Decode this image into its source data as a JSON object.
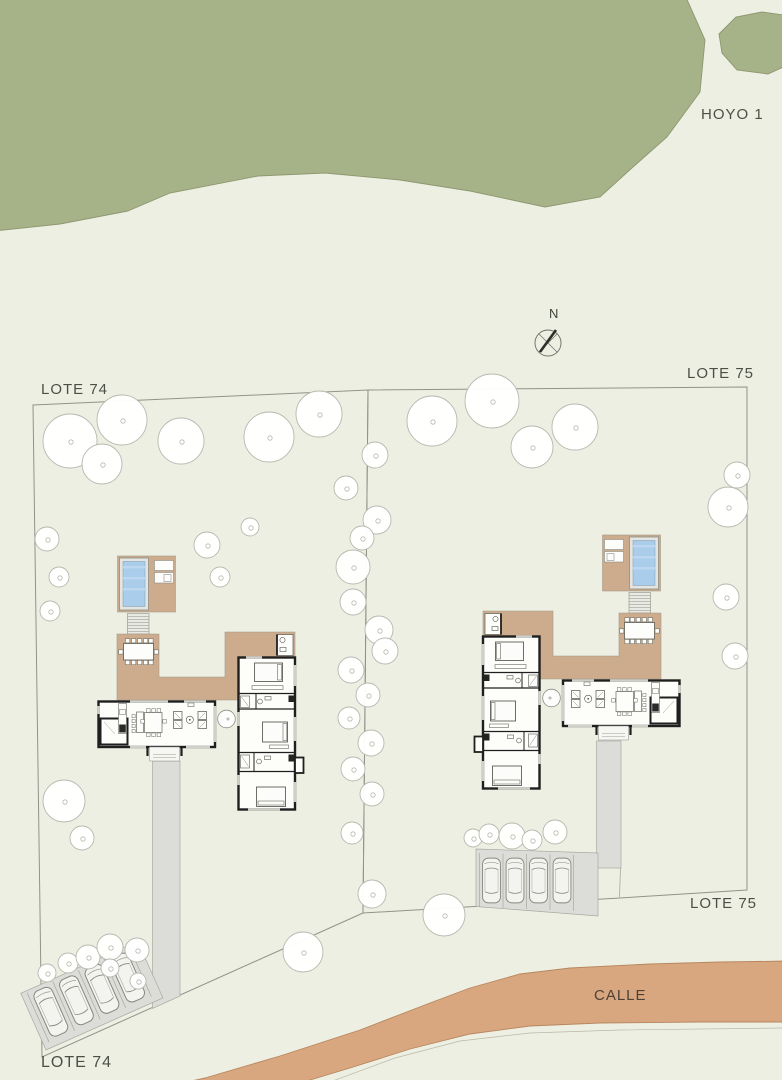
{
  "labels": {
    "golf_hole": "HOYO 1",
    "lot74_top": "LOTE 74",
    "lot74_bottom": "LOTE 74",
    "lot75_top": "LOTE 75",
    "lot75_bottom": "LOTE 75",
    "street": "CALLE",
    "north": "N"
  },
  "colors": {
    "background": "#edefe2",
    "golf_green": "#a6b288",
    "street": "#d8a67f",
    "terrace_tan": "#cdab8d",
    "pool_water": "#a9cdea",
    "paving_gray": "#dcddd8",
    "wall_black": "#1f1f1f",
    "boundary_line": "#8f948a",
    "tree_outline": "#b5b9af",
    "label_text": "#4b5046"
  },
  "site": {
    "lots": [
      {
        "id": "lot-74",
        "label": "LOTE 74"
      },
      {
        "id": "lot-75",
        "label": "LOTE 75"
      }
    ],
    "houses": 2,
    "trees": [
      [
        70,
        441,
        27
      ],
      [
        122,
        420,
        25
      ],
      [
        102,
        464,
        20
      ],
      [
        181,
        441,
        23
      ],
      [
        269,
        437,
        25
      ],
      [
        319,
        414,
        23
      ],
      [
        432,
        421,
        25
      ],
      [
        492,
        401,
        27
      ],
      [
        532,
        447,
        21
      ],
      [
        575,
        427,
        23
      ],
      [
        47,
        539,
        12
      ],
      [
        59,
        577,
        10
      ],
      [
        50,
        611,
        10
      ],
      [
        207,
        545,
        13
      ],
      [
        220,
        577,
        10
      ],
      [
        250,
        527,
        9
      ],
      [
        375,
        455,
        13
      ],
      [
        346,
        488,
        12
      ],
      [
        377,
        520,
        14
      ],
      [
        362,
        538,
        12
      ],
      [
        353,
        567,
        17
      ],
      [
        353,
        602,
        13
      ],
      [
        379,
        630,
        14
      ],
      [
        385,
        651,
        13
      ],
      [
        351,
        670,
        13
      ],
      [
        368,
        695,
        12
      ],
      [
        349,
        718,
        11
      ],
      [
        371,
        743,
        13
      ],
      [
        353,
        769,
        12
      ],
      [
        372,
        794,
        12
      ],
      [
        64,
        801,
        21
      ],
      [
        82,
        838,
        12
      ],
      [
        352,
        833,
        11
      ],
      [
        47,
        973,
        9
      ],
      [
        68,
        963,
        10
      ],
      [
        88,
        957,
        12
      ],
      [
        110,
        947,
        13
      ],
      [
        137,
        950,
        12
      ],
      [
        110,
        968,
        9
      ],
      [
        138,
        981,
        8
      ],
      [
        303,
        952,
        20
      ],
      [
        444,
        915,
        21
      ],
      [
        372,
        894,
        14
      ],
      [
        737,
        475,
        13
      ],
      [
        728,
        507,
        20
      ],
      [
        726,
        597,
        13
      ],
      [
        735,
        656,
        13
      ],
      [
        473,
        838,
        9
      ],
      [
        489,
        834,
        10
      ],
      [
        512,
        836,
        13
      ],
      [
        532,
        840,
        10
      ],
      [
        555,
        832,
        12
      ]
    ],
    "cars": {
      "lot74": {
        "count": 4,
        "size": [
          23,
          52
        ],
        "positions": [
          [
            8.5,
            -59
          ],
          [
            36.5,
            -59
          ],
          [
            64.5,
            -59
          ],
          [
            92.5,
            -59
          ]
        ]
      },
      "lot75": {
        "count": 4,
        "size": [
          20,
          53
        ],
        "positions": [
          [
            481.5,
            854
          ],
          [
            505,
            854
          ],
          [
            528.5,
            854
          ],
          [
            552,
            854
          ]
        ]
      }
    }
  }
}
